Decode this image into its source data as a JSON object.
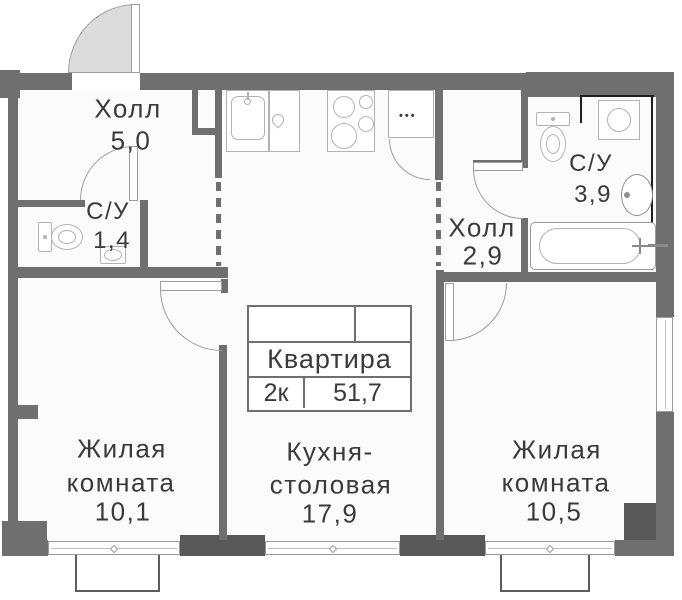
{
  "apartment_card": {
    "title": "Квартира",
    "rooms_short": "2к",
    "total_area": "51,7"
  },
  "rooms": {
    "hall5": {
      "label": "Холл",
      "area": "5,0"
    },
    "su14": {
      "label": "С/У",
      "area": "1,4"
    },
    "hall29": {
      "label": "Холл",
      "area": "2,9"
    },
    "su39": {
      "label": "С/У",
      "area": "3,9"
    },
    "kitchen": {
      "label1": "Кухня-",
      "label2": "столовая",
      "area": "17,9"
    },
    "room101": {
      "label1": "Жилая",
      "label2": "комната",
      "area": "10,1"
    },
    "room105": {
      "label1": "Жилая",
      "label2": "комната",
      "area": "10,5"
    }
  },
  "fixtures": {
    "fridge_dots": "•••"
  },
  "icons": [
    "entry-door-icon",
    "toilet-icon",
    "sink-icon",
    "dishwasher-drop-icon",
    "stove-icon",
    "fridge-icon",
    "washing-machine-icon",
    "bathtub-icon",
    "window-icon",
    "balcony-icon",
    "door-arc-icon"
  ],
  "colors": {
    "wall": "#6f6f6f",
    "wall-dark": "#585858",
    "line": "#9e9e9e",
    "fixture": "#b2b2b2",
    "text": "#3a3a3a",
    "door-fill": "#dcdcdc",
    "floor": "#fbfbfb",
    "black": "#1e1e1e"
  }
}
